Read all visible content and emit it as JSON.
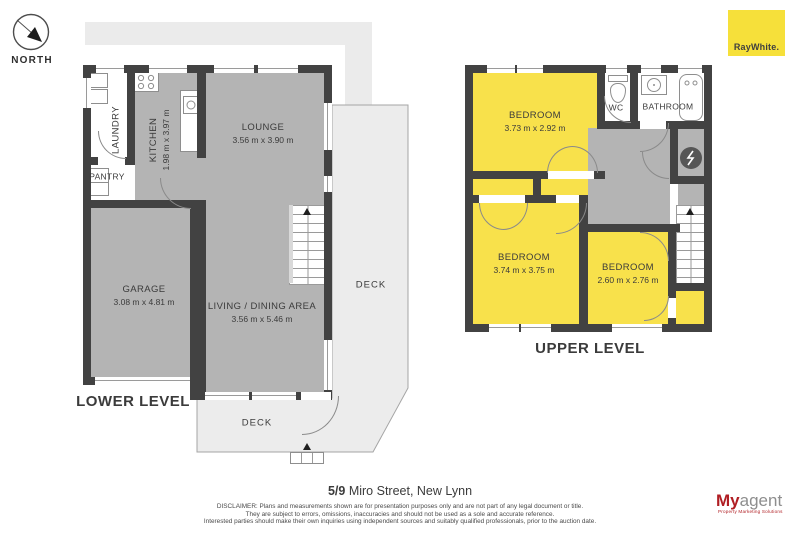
{
  "compass": {
    "label": "NORTH",
    "icon": "compass-needle-arrow"
  },
  "logo_raywhite": {
    "text": "RayWhite."
  },
  "logo_myagent": {
    "part1": "My",
    "part2": "agent",
    "tagline": "Property Marketing Solutions"
  },
  "lower_level": {
    "title": "LOWER LEVEL",
    "rooms": {
      "laundry": {
        "name": "LAUNDRY"
      },
      "kitchen": {
        "name": "KITCHEN",
        "dims": "1.98 m x 3.97 m"
      },
      "pantry": {
        "name": "PANTRY"
      },
      "lounge": {
        "name": "LOUNGE",
        "dims": "3.56 m x 3.90 m"
      },
      "garage": {
        "name": "GARAGE",
        "dims": "3.08 m x 4.81 m"
      },
      "living_dining": {
        "name": "LIVING / DINING AREA",
        "dims": "3.56 m x 5.46 m"
      },
      "deck_side": {
        "name": "DECK"
      },
      "deck_front": {
        "name": "DECK"
      }
    },
    "icons": [
      "stove-icon",
      "kitchen-sink-icon",
      "laundry-appliance-icon",
      "stairs-up-arrow"
    ]
  },
  "upper_level": {
    "title": "UPPER LEVEL",
    "rooms": {
      "bedroom_top": {
        "name": "BEDROOM",
        "dims": "3.73 m x 2.92 m"
      },
      "bedroom_main": {
        "name": "BEDROOM",
        "dims": "3.74 m x 3.75 m"
      },
      "bedroom_small": {
        "name": "BEDROOM",
        "dims": "2.60 m x 2.76 m"
      },
      "wc": {
        "name": "WC"
      },
      "bathroom": {
        "name": "BATHROOM"
      }
    },
    "icons": [
      "toilet-icon",
      "basin-icon",
      "bathtub-icon",
      "hot-water-cylinder-icon",
      "stairs-up-arrow"
    ]
  },
  "footer": {
    "address_unit": "5/9",
    "address_street": " Miro Street, New Lynn",
    "disclaimer": [
      "DISCLAIMER: Plans and measurements shown are for presentation purposes only and are not part of any legal document or title.",
      "They are subject to errors, omissions, inaccuracies and should not be used as a sole and accurate reference.",
      "Interested parties should make their own inquiries using independent sources and suitably qualified professionals, prior to the auction date."
    ]
  },
  "colors": {
    "room_yellow": "#f8e14b",
    "room_gray": "#b4b4b4",
    "wall": "#424242",
    "band_gray": "#ebebeb",
    "deck_fill": "#ececec",
    "brand_yellow": "#f6e03a",
    "brand_red": "#b01e23"
  }
}
